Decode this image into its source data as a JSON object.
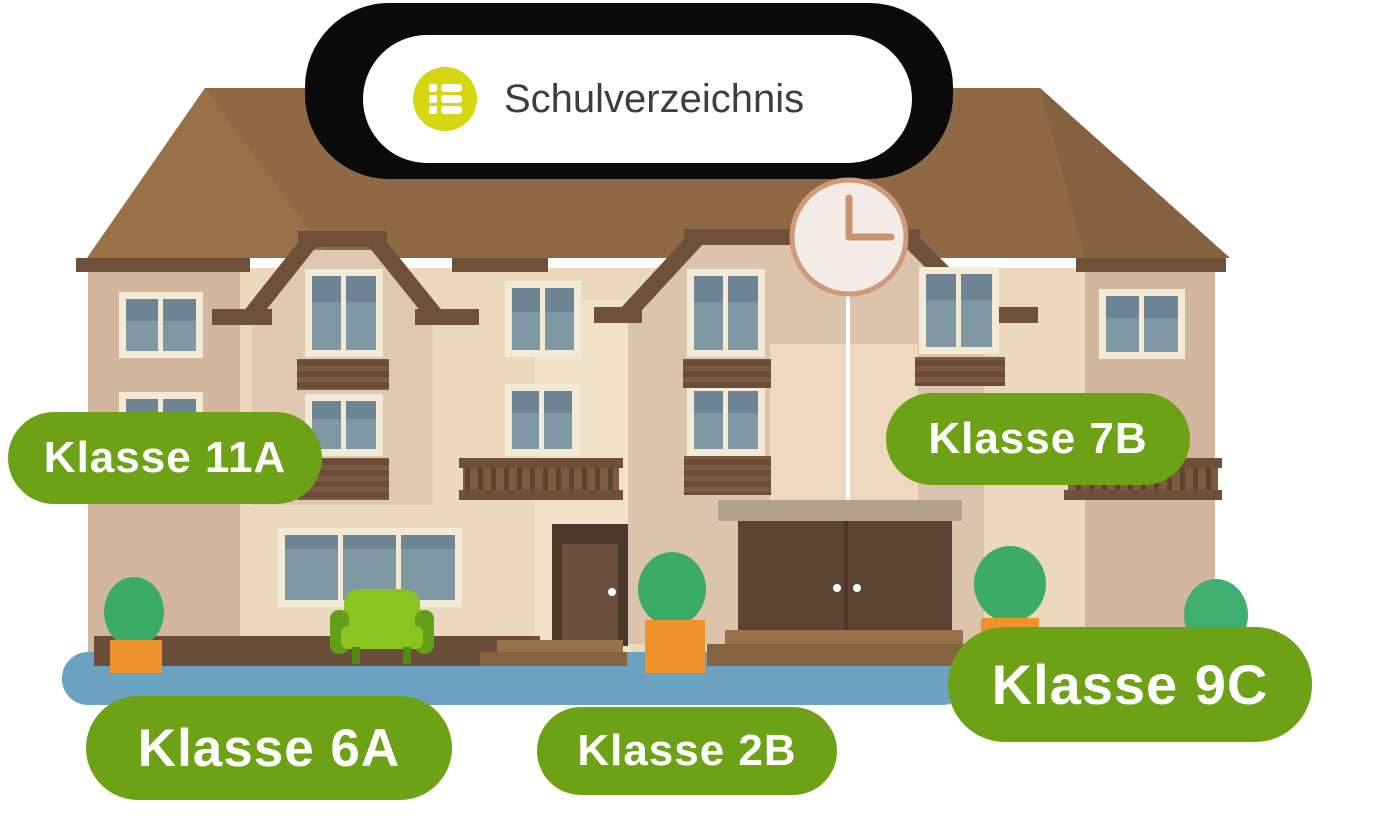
{
  "header": {
    "label": "Schulverzeichnis",
    "icon": "list-icon"
  },
  "class_labels": [
    {
      "id": "11a",
      "text": "Klasse 11A"
    },
    {
      "id": "7b",
      "text": "Klasse 7B"
    },
    {
      "id": "6a",
      "text": "Klasse 6A"
    },
    {
      "id": "2b",
      "text": "Klasse 2B"
    },
    {
      "id": "9c",
      "text": "Klasse 9C"
    }
  ],
  "colors": {
    "label_green": "#6da216",
    "label_text": "#ffffff",
    "icon_circle_yellow": "#d6d712",
    "header_text": "#3d3d3d",
    "header_background": "#ffffff",
    "backdrop_black": "#0a0a0a",
    "roof_brown": "#8f6845",
    "roof_trim_brown": "#6f5039",
    "wall_beige": "#ecd8bd",
    "tower_taupe": "#d2b69e",
    "window_pane_blue": "#8097a4",
    "ground_blue": "#6ba2c2",
    "bush_green": "#3cab68",
    "pot_orange": "#f0922b",
    "couch_lime": "#8cc41f",
    "clock_face": "#f3ebe5",
    "clock_rim": "#cf9a79"
  }
}
